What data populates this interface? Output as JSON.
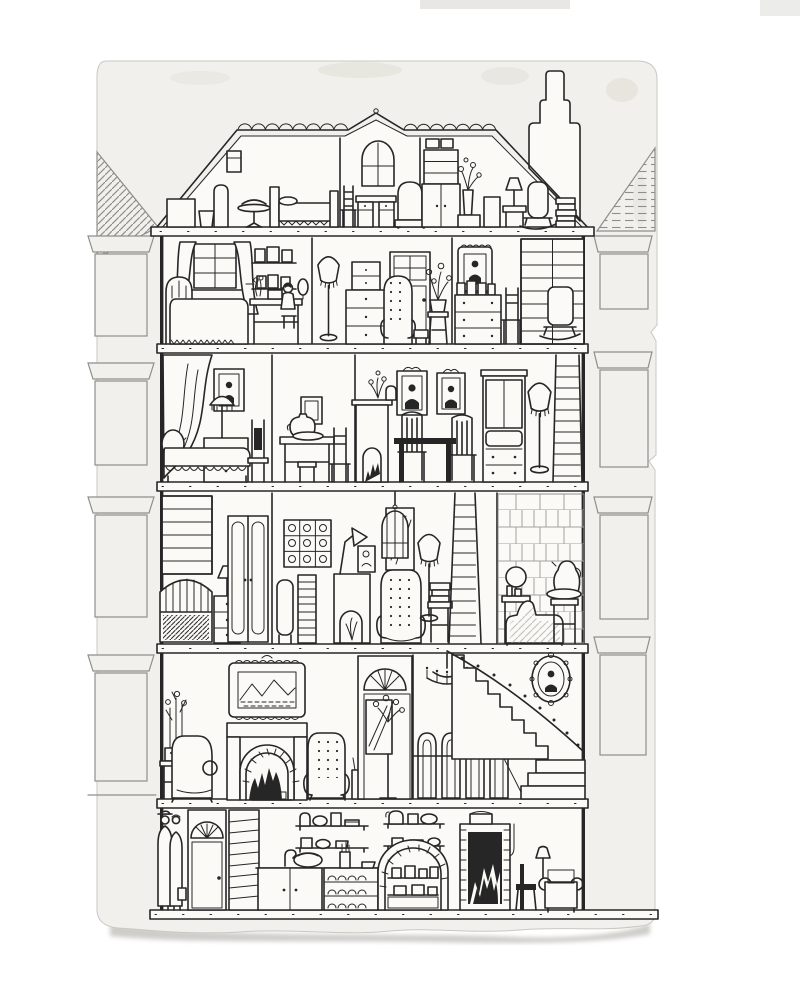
{
  "artwork": {
    "title": "Dollhouse cross-section — pen and ink illustration",
    "description": "Hand-drawn cutaway of a six-level Victorian dollhouse on an aged card with rounded top corners and a torn bottom edge. Neighbouring facades with hatched sash windows flank the house. A chimney rises from the right roof slope; a gabled arched window sits on the ridge.",
    "medium": "pen and ink on paper",
    "palette": {
      "bg": "#ffffff",
      "paper": "#f1f0ec",
      "room": "#fbfaf7",
      "ink": "#262626",
      "pencil": "#8f8e8a",
      "stain": "#e3e1da",
      "shadow": "#aeaca6",
      "edge": "#c9c7c1"
    }
  },
  "house": {
    "exterior": [
      "scalloped ridge tiles",
      "central gable with arched window",
      "stepped chimney pot",
      "double-line outer walls",
      "ground slab extending to paper edges"
    ],
    "floors": [
      {
        "name": "attic",
        "rooms": [
          {
            "name": "attic-left",
            "items": [
              "wicker basket",
              "bucket",
              "wall box",
              "tall mirror",
              "pedestal table with bowl",
              "slat bed with fringed blanket"
            ]
          },
          {
            "name": "attic-centre",
            "items": [
              "arched gable window",
              "ladder-back chair",
              "pedestal desk",
              "dotted armchair"
            ]
          },
          {
            "name": "attic-right",
            "items": [
              "hat boxes",
              "bookshelf over cupboard",
              "flowers in vase on cabinet",
              "wicker hamper",
              "lamp on stand",
              "hatched rocking chair",
              "stack of books"
            ]
          }
        ]
      },
      {
        "name": "bedroom-floor",
        "rooms": [
          {
            "name": "master-bedroom",
            "items": [
              "curtained sash window",
              "spindle bed with dotted coverlet",
              "two picture shelves",
              "dressing table with seated girl",
              "oval mirror"
            ]
          },
          {
            "name": "dressing-room",
            "items": [
              "fringed floor lamp",
              "tallboy chest",
              "glazed door",
              "dotted wing chair",
              "footstool",
              "potted flowers on stand"
            ]
          },
          {
            "name": "study-corner",
            "items": [
              "scallop-framed portrait",
              "chest with photographs",
              "side chair",
              "hatched rocking chair",
              "double bookcase"
            ]
          }
        ]
      },
      {
        "name": "sitting-floor",
        "rooms": [
          {
            "name": "boudoir",
            "items": [
              "looped pelmet",
              "swagged drape",
              "framed portrait",
              "lamp on two-drawer chest",
              "daybed with scalloped skirt",
              "dark hall chair"
            ]
          },
          {
            "name": "wash-room",
            "items": [
              "small picture",
              "table with pitcher and basin",
              "stool",
              "side chair"
            ]
          },
          {
            "name": "dining-room",
            "items": [
              "tiled stove with flowers and jug",
              "two crested portraits",
              "black dining table",
              "two slat chairs",
              "lattice china cabinet",
              "fringed floor lamp"
            ]
          },
          {
            "name": "ladder",
            "items": [
              "wooden ladder"
            ]
          }
        ]
      },
      {
        "name": "library-floor",
        "rooms": [
          {
            "name": "library",
            "items": [
              "bookcase",
              "spindle settee",
              "nightstand with lamp",
              "double wardrobe doors"
            ]
          },
          {
            "name": "studio",
            "items": [
              "grid of prints",
              "book stacks",
              "hatched chair back",
              "display stove with dried grasses",
              "leaf sculpture lamp",
              "easel figure",
              "hanging birdcage",
              "leaning mirror",
              "button-tufted armchair",
              "fringed floor lamp",
              "table with book pile"
            ]
          },
          {
            "name": "ladder",
            "items": [
              "tall ladder"
            ]
          },
          {
            "name": "bathroom",
            "items": [
              "tiled wall",
              "washstand with round mirror and bottles",
              "slipper bathtub",
              "pedestal with basin and ewer"
            ]
          }
        ]
      },
      {
        "name": "parlour-floor",
        "rooms": [
          {
            "name": "parlour",
            "items": [
              "potted hyacinths on stand",
              "scroll armchair",
              "ornate framed landscape",
              "striped fireplace with brick arch and fire",
              "dotted armchair",
              "umbrella stand",
              "fanlight front door",
              "hall mirror with flowers"
            ]
          },
          {
            "name": "stair-hall",
            "items": [
              "candle chandelier",
              "four high-back chairs behind rail",
              "curved staircase",
              "beaded banister",
              "oval portrait"
            ]
          }
        ]
      },
      {
        "name": "basement-kitchen",
        "rooms": [
          {
            "name": "entry",
            "items": [
              "two standing figures",
              "fanlight door",
              "boxed stair"
            ]
          },
          {
            "name": "kitchen",
            "items": [
              "two crockery shelves",
              "tap and basin",
              "cupboards",
              "plate rack",
              "brick pantry arch with pots",
              "black range with fire and pot",
              "side chair",
              "settee with lamp",
              "floor pole"
            ]
          }
        ]
      }
    ]
  },
  "neighbors": {
    "left": {
      "windows": 4,
      "style": "striped cornices, hatched panes, diagonal hatched roof"
    },
    "right": {
      "windows": 4,
      "style": "striped cornices, hatched panes, dashed hatched roof, torn paper edge"
    }
  },
  "paper": {
    "note": "aged card, rounded top corners, stains, torn deckled bottom edge with soft shadow"
  }
}
